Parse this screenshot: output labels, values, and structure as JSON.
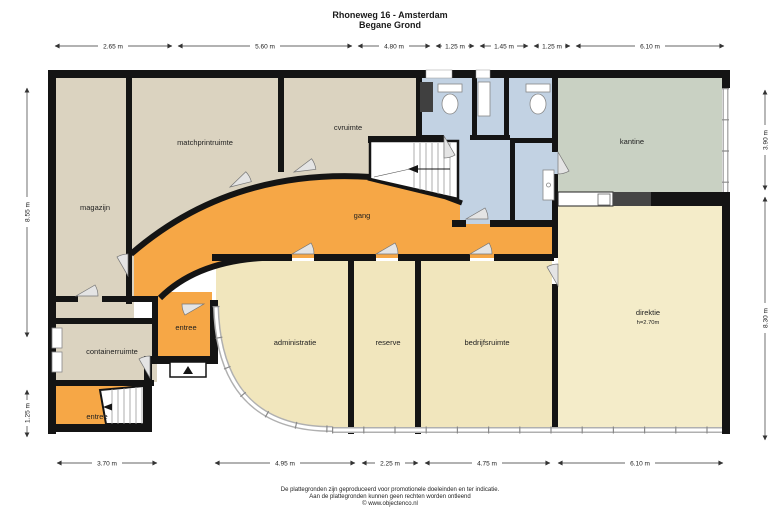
{
  "title": "Rhoneweg 16 - Amsterdam",
  "subtitle": "Begane Grond",
  "rooms": {
    "magazijn": "magazijn",
    "matchprintruimte": "matchprintruimte",
    "cvruimte": "cvruimte",
    "gang": "gang",
    "kantine": "kantine",
    "direktie": "direktie",
    "direktie_height": "h=2.70m",
    "administratie": "administratie",
    "reserve": "reserve",
    "bedrijfsruimte": "bedrijfsruimte",
    "containerruimte": "containerruimte",
    "entree_mid": "entree",
    "entree_bottom": "entree"
  },
  "dimensions": {
    "top": [
      "2.65 m",
      "5.60 m",
      "4.80 m",
      "1.25 m",
      "1.45 m",
      "1.25 m",
      "6.10 m"
    ],
    "bottom": [
      "3.70 m",
      "4.95 m",
      "2.25 m",
      "4.75 m",
      "6.10 m"
    ],
    "left": [
      "8.55 m",
      "1.25 m"
    ],
    "right": [
      "3.90 m",
      "8.30 m"
    ]
  },
  "footer": {
    "line1": "De plattegronden zijn geproduceerd voor promotionele doeleinden en ter indicatie.",
    "line2": "Aan de plattegronden kunnen geen rechten worden ontleend",
    "line3": "© www.objectenco.nl"
  },
  "colors": {
    "wall": "#141414",
    "room_beige": "#DBD3C0",
    "room_yellow": "#F1E6BD",
    "room_yellow_light": "#F4ECC9",
    "room_orange": "#F6A746",
    "room_sage": "#C9D1C3",
    "room_blue": "#C2D2E3"
  }
}
